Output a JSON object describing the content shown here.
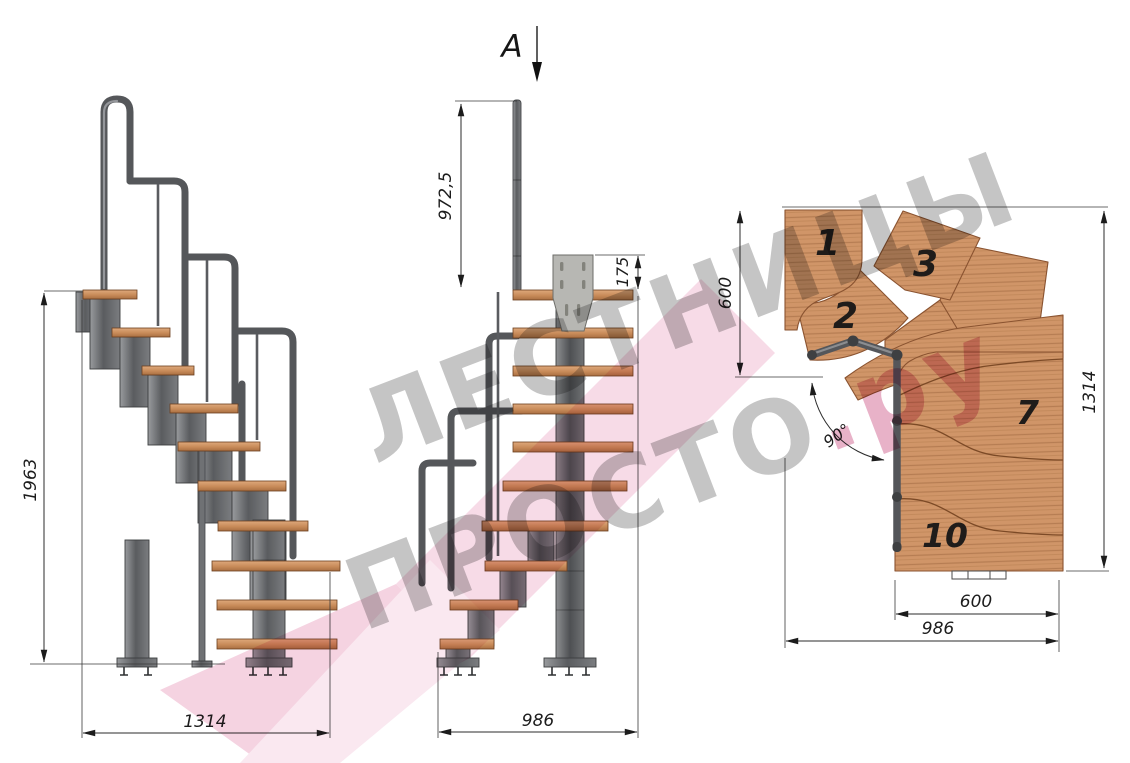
{
  "section": {
    "label": "A"
  },
  "left_view": {
    "dim_height": "1963",
    "dim_length": "1314"
  },
  "front_view": {
    "dim_handrail_post": "972,5",
    "dim_bracket": "175",
    "dim_length": "986"
  },
  "plan_view": {
    "dim_entry_width": "600",
    "dim_depth": "1314",
    "dim_tread_width": "600",
    "dim_total_width": "986",
    "dim_turn_angle": "90°",
    "steps": [
      {
        "label": "1"
      },
      {
        "label": "2"
      },
      {
        "label": "3"
      },
      {
        "label": "7"
      },
      {
        "label": "10"
      }
    ]
  },
  "watermark": {
    "line1": "ЛЕСТНИЦЫ",
    "line2": "ПРОСТО",
    "suffix": ".ру"
  },
  "palette": {
    "wood": "#cf9468",
    "wood_dark": "#a96f42",
    "metal": "#6f7174",
    "metal_dark": "#46484b",
    "dimension_lines": "#2b2b2b",
    "watermark_gray": "#bdbdbd",
    "watermark_pink": "#f2c3d7"
  }
}
